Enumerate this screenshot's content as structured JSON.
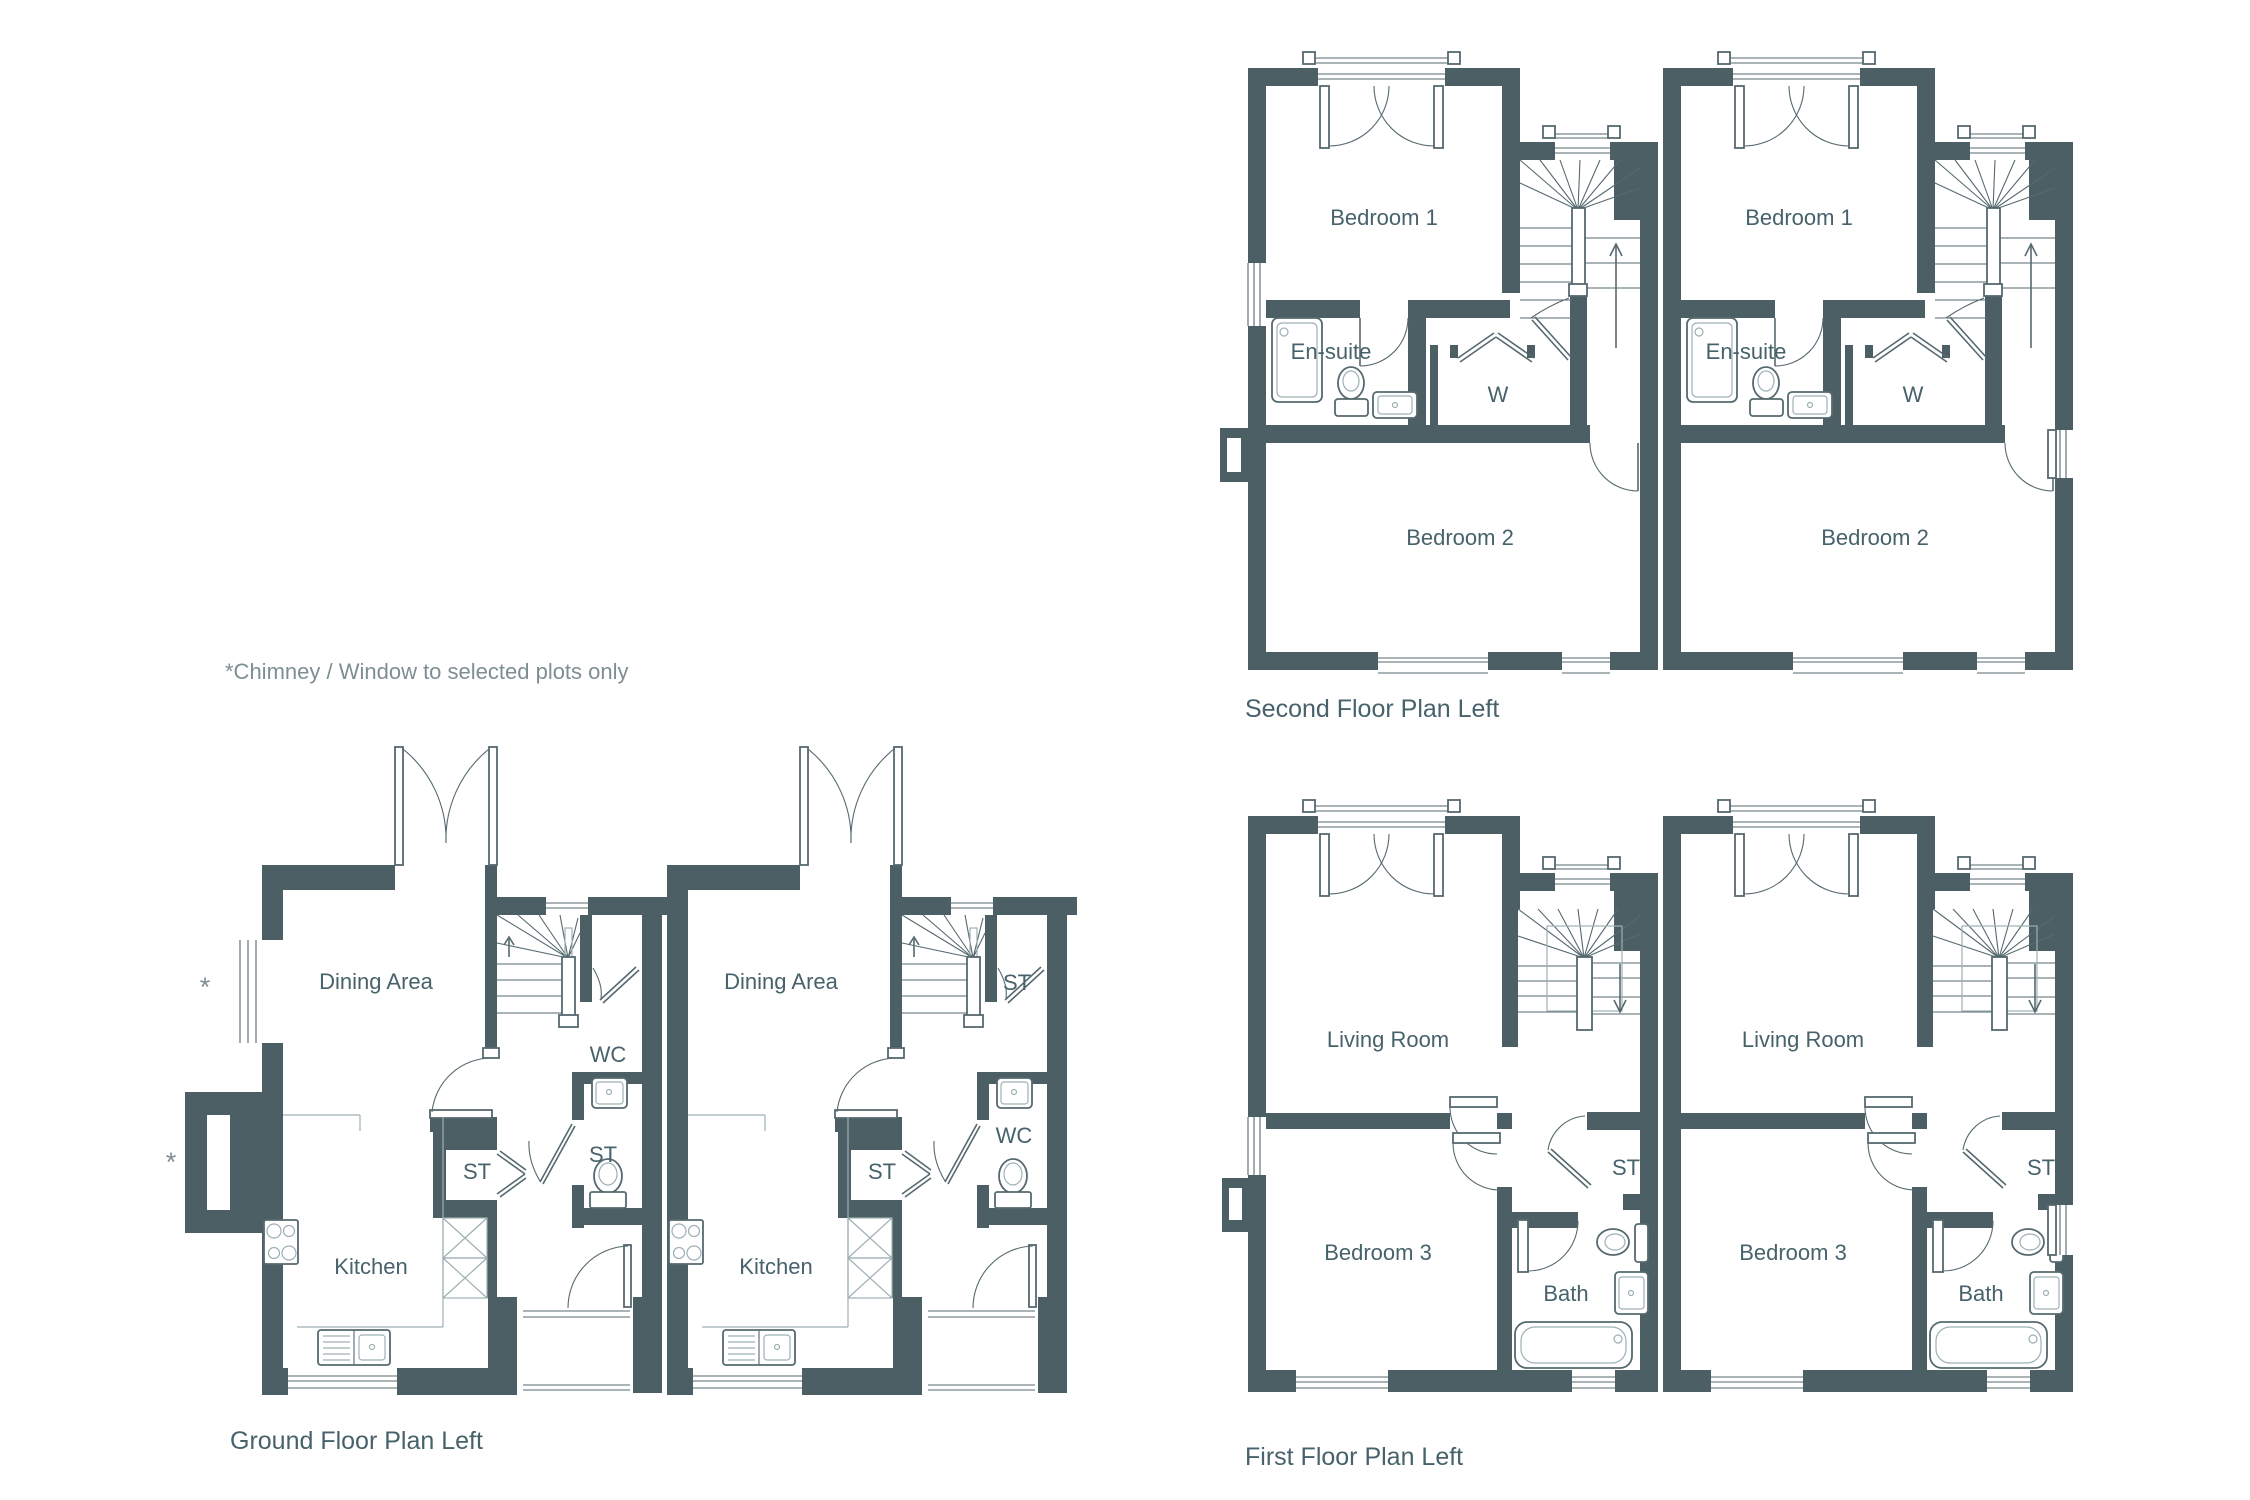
{
  "colors": {
    "wall": "#4c5f65",
    "line": "#56696f",
    "faint": "#9db0b3",
    "text": "#47626b",
    "note": "#7e8e92",
    "bg": "#ffffff"
  },
  "note": "*Chimney / Window to selected plots only",
  "asterisk": "*",
  "floors": {
    "second": {
      "title": "Second Floor Plan Left",
      "units": [
        {
          "bedroom1": "Bedroom 1",
          "ensuite": "En-suite",
          "wardrobe": "W",
          "bedroom2": "Bedroom 2"
        },
        {
          "bedroom1": "Bedroom 1",
          "ensuite": "En-suite",
          "wardrobe": "W",
          "bedroom2": "Bedroom 2"
        }
      ]
    },
    "first": {
      "title": "First Floor Plan Left",
      "units": [
        {
          "living": "Living Room",
          "storage": "ST",
          "bedroom3": "Bedroom 3",
          "bath": "Bath"
        },
        {
          "living": "Living Room",
          "storage": "ST",
          "bedroom3": "Bedroom 3",
          "bath": "Bath"
        }
      ]
    },
    "ground": {
      "title": "Ground Floor Plan Left",
      "units": [
        {
          "dining": "Dining Area",
          "stairs_closet": "WC",
          "side_room": "ST",
          "mid_closet": "ST",
          "kitchen": "Kitchen"
        },
        {
          "dining": "Dining Area",
          "stairs_closet": "ST",
          "side_room": "WC",
          "mid_closet": "ST",
          "kitchen": "Kitchen"
        }
      ]
    }
  }
}
